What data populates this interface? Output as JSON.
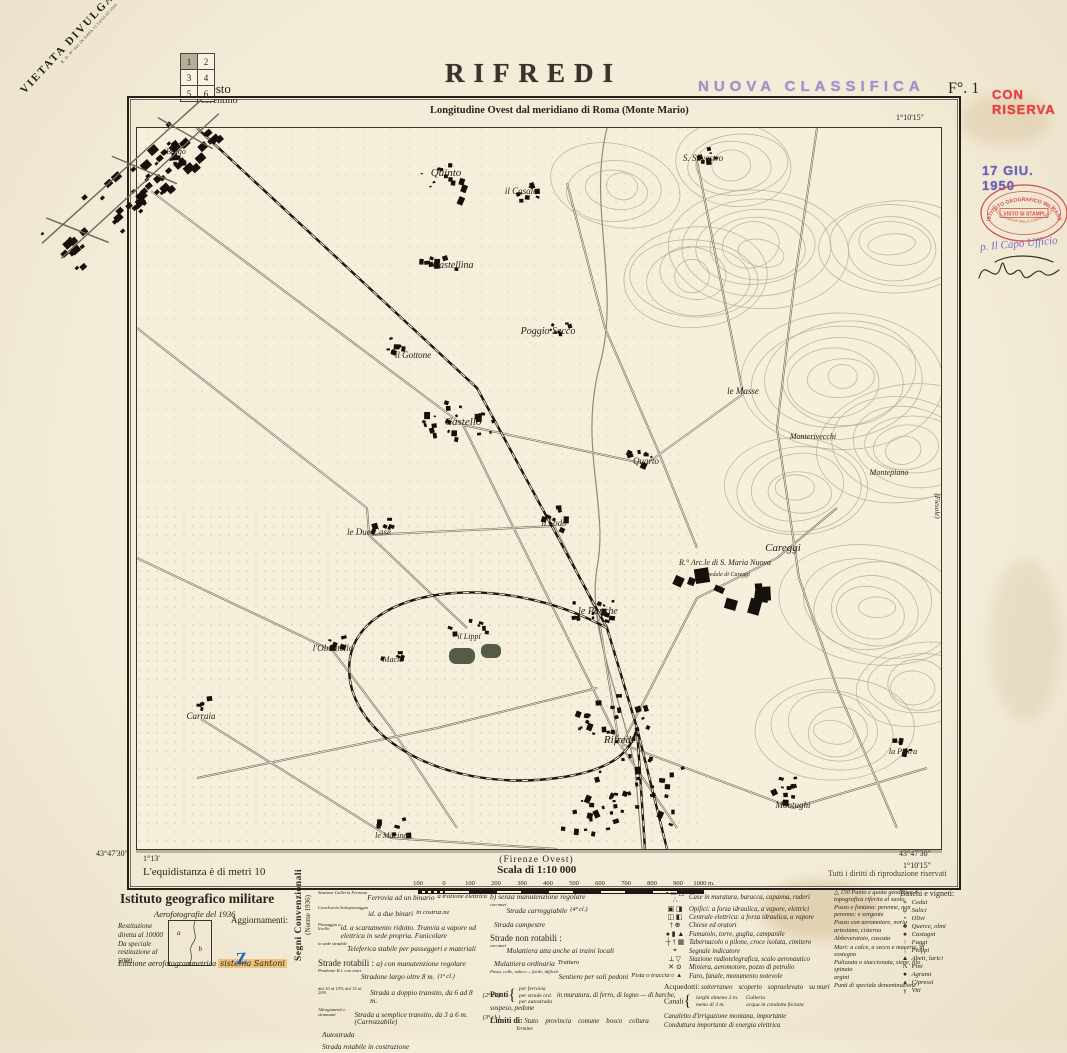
{
  "header": {
    "title": "RIFREDI",
    "classification_stamp": "NUOVA CLASSIFICA",
    "sheet_number": "F°. 1",
    "reserve_stamp": "CON RISERVA",
    "prohibition_line1": "VIETATA DIVULGAZIONE",
    "prohibition_line2": "R. D. N° 561 IN DATA 11 LUGLIO 1941",
    "subtitle": "Longitudine Ovest dal meridiano di Roma (Monte Mario)",
    "index_grid": [
      "1",
      "2",
      "3",
      "4",
      "5",
      "6"
    ],
    "outside_town_line1": "Sesto",
    "outside_town_line2": "Fiorentino"
  },
  "coordinates": {
    "top_right_lon": "1°10'15\"",
    "top_right_lat": "43°50'",
    "bottom_left_lat": "43°47'30\"",
    "bottom_left_lon": "1°13'",
    "bottom_right_lat": "43°47'30\"",
    "bottom_right_lon": "1°10'15\"",
    "right_edge_sheet": "(Fiesole)"
  },
  "map": {
    "labels": [
      {
        "t": "Borgo",
        "x": 39,
        "y": 26,
        "s": 8
      },
      {
        "t": "Quinto",
        "x": 309,
        "y": 48,
        "s": 11
      },
      {
        "t": "S. Silvestro",
        "x": 566,
        "y": 33,
        "s": 9
      },
      {
        "t": "il Casale",
        "x": 384,
        "y": 66,
        "s": 9
      },
      {
        "t": "Castellina",
        "x": 316,
        "y": 140,
        "s": 10
      },
      {
        "t": "Poggio Secco",
        "x": 411,
        "y": 206,
        "s": 10
      },
      {
        "t": "il Gottone",
        "x": 276,
        "y": 230,
        "s": 9
      },
      {
        "t": "Castello",
        "x": 326,
        "y": 297,
        "s": 11
      },
      {
        "t": "Quarto",
        "x": 509,
        "y": 336,
        "s": 9
      },
      {
        "t": "le Masse",
        "x": 606,
        "y": 266,
        "s": 9
      },
      {
        "t": "Monterivecchi",
        "x": 676,
        "y": 311,
        "s": 8
      },
      {
        "t": "Montepiano",
        "x": 752,
        "y": 347,
        "s": 8
      },
      {
        "t": "le Due Case",
        "x": 232,
        "y": 407,
        "s": 9
      },
      {
        "t": "il Sodo",
        "x": 417,
        "y": 398,
        "s": 9
      },
      {
        "t": "Careggi",
        "x": 646,
        "y": 423,
        "s": 11
      },
      {
        "t": "R.° Arc.le di S. Maria Nuova",
        "x": 588,
        "y": 437,
        "s": 8
      },
      {
        "t": "Ospedale di Careggi",
        "x": 588,
        "y": 448,
        "s": 6
      },
      {
        "t": "le Panche",
        "x": 461,
        "y": 486,
        "s": 10
      },
      {
        "t": "l'Olmatello",
        "x": 196,
        "y": 523,
        "s": 9
      },
      {
        "t": "Macia",
        "x": 256,
        "y": 534,
        "s": 8
      },
      {
        "t": "il Lippi",
        "x": 332,
        "y": 511,
        "s": 8
      },
      {
        "t": "Carraia",
        "x": 64,
        "y": 591,
        "s": 9
      },
      {
        "t": "Rifredi",
        "x": 482,
        "y": 615,
        "s": 11
      },
      {
        "t": "Montughi",
        "x": 656,
        "y": 680,
        "s": 9
      },
      {
        "t": "la Pietra",
        "x": 766,
        "y": 626,
        "s": 8
      },
      {
        "t": "le Macine",
        "x": 254,
        "y": 710,
        "s": 8
      },
      {
        "t": "(Fiesole)",
        "x": 798,
        "y": 378,
        "s": 7,
        "r": 90
      }
    ]
  },
  "footer": {
    "adjacent_sheet": "(Firenze Ovest)",
    "scale_title": "Scala di 1:10 000",
    "scale_ticks": [
      "100",
      "0",
      "100",
      "200",
      "300",
      "400",
      "500",
      "600",
      "700",
      "800",
      "900",
      "1000 m."
    ],
    "equidistance": "L'equidistanza è di metri 10",
    "rights": "Tutti i diritti di riproduzione riservati"
  },
  "stamps": {
    "date": "17 GIU. 1950",
    "oval_top": "ISTITUTO GEOGRAFICO MILITARE",
    "oval_middle": "VISTO SI STAMPI",
    "oval_bottom": "STAMPA E REVISIONE DELLE CARTE DELLO STATO",
    "handwritten_role": "p. Il Capo Ufficio"
  },
  "legend": {
    "institute": "Istituto geografico militare",
    "aerophoto": "Aerofotografie del 1936",
    "updates_label": "Aggiornamenti:",
    "diagram_a": "a",
    "diagram_b": "b",
    "sources": [
      "Restituzione diretta al 10000",
      "Da speciale restituzione al 5000"
    ],
    "edition_note": "Edizione aerofotogrammetrica",
    "edition_handwritten": "sistema Santoni",
    "edition_mark": "Z",
    "conventional_title": "Segni Convenzionali",
    "conventional_subtitle": "(Norme 1936)",
    "railways": [
      {
        "sym": "rail1",
        "micro": "Stazione   Galleria   Fermata",
        "label": "Ferrovia ad un binario",
        "cls": "a trazione elettrica"
      },
      {
        "sym": "rail2",
        "micro": "Cavalcavia   Sottopassaggio",
        "label": "id.  a due binari",
        "cls": "in costruz.ne"
      },
      {
        "sym": "railn",
        "micro": "Passaggio a livello",
        "label": "id.  a scartamento ridotto. Tranvia a vapore od elettrica in sede propria. Funicolare"
      },
      {
        "sym": "tele",
        "micro": "in sede stradale",
        "label": "Teleferica stabile per passeggeri e materiali"
      }
    ],
    "roads_title": "Strade rotabili :",
    "roads_a": "a) con manutenzione regolare",
    "roads": [
      {
        "sym": "road1",
        "micro": "Pendenze    K.l.    con muri",
        "label": "Stradone largo oltre 8 m.",
        "cls": "(1ª cl.)"
      },
      {
        "sym": "road2",
        "micro": "dal 10 al 15%   dal 15 al 20%",
        "label": "Strada a doppio transito, da 6 ad 8 m.",
        "cls": "(2ª cl.)"
      },
      {
        "sym": "road3",
        "micro": "Allargamenti e stramazzi",
        "label": "Strada a semplice transito, da 3 a 6 m. (Carrozzabile)",
        "cls": "(3ª cl.)"
      },
      {
        "sym": "auto",
        "label": "Autostrada"
      },
      {
        "sym": "roadc",
        "label": "Strada rotabile in costruzione"
      }
    ],
    "roads_b": "b) senza manutenzione regolare",
    "roads2": [
      {
        "sym": "carr",
        "micro": "con muri",
        "label": "Strada carreggiabile",
        "cls": "(4ª cl.)"
      },
      {
        "sym": "camp",
        "label": "Strada campestre"
      }
    ],
    "nonroads_title": "Strade non rotabili :",
    "nonroads": [
      {
        "sym": "mul1",
        "micro": "con muri",
        "label": "Mulattiera atta anche ai traini locali"
      },
      {
        "sym": "mul2",
        "label": "Mulattiera ordinaria",
        "cls": "Tratturo"
      },
      {
        "sym": "sent",
        "micro": "Passo, colle, valico — facile, difficile",
        "label": "Sentiero per soli pedoni",
        "cls": "Pista o traccia"
      }
    ],
    "bridges_title": "Ponti",
    "bridges_rows": [
      "per ferrovia",
      "per strade ord.",
      "per autostrada"
    ],
    "bridges_types1": "in muratura, di ferro, di legno",
    "bridges_types2": "di barche, sospeso, pedone",
    "limits_title": "Limiti di:",
    "limits_items": [
      "Stato",
      "provincia",
      "comune",
      "bosco",
      "coltura"
    ],
    "limits_sub": "Termine",
    "symbols": [
      {
        "g": "▪ ▭ △ ∴",
        "label": "Case in muratura, baracca, capanna, ruderi"
      },
      {
        "g": "▣ ◨",
        "label": "Opifici: a forza idraulica, a vapore, elettrici"
      },
      {
        "g": "◫ ◧",
        "label": "Centrale elettrica: a forza idraulica, a vapore"
      },
      {
        "g": "† ⊕",
        "label": "Chiese ed oratori"
      },
      {
        "g": "● ▮ ▲",
        "label": "Fumaiolo, torre, guglia, campanile"
      },
      {
        "g": "┼ † ▦",
        "label": "Tabernacolo o pilone, croce isolata, cimitero"
      },
      {
        "g": "⌖",
        "label": "Segnale indicatore"
      },
      {
        "g": "⟂ ▽",
        "label": "Stazione radiotelegrafica, scalo aeronautico"
      },
      {
        "g": "✕ ⊙",
        "label": "Miniera, aeromotore, pozzo di petrolio"
      },
      {
        "g": "☼ ▴",
        "label": "Faro, fanale, monumento notevole"
      }
    ],
    "aqueducts_title": "Acquedotti:",
    "aqueducts_items": [
      "sotterraneo",
      "scoperto",
      "sopraelevato",
      "su muri"
    ],
    "canals_title": "Canali",
    "canals_rows": [
      "larghi almeno 3 m.",
      "meno di 3 m."
    ],
    "canals_notes": [
      "Galleria",
      "acqua in condotta forzata"
    ],
    "canal_extra1": "Canaletto d'irrigazione montana, importante",
    "canal_extra2": "Conduttura importante di energia elettrica",
    "points": [
      "△ 150  Punto e quota geodetica e topografica riferita al suolo",
      "Pozzo e fontana: perenne, non perenne; e sorgente",
      "Pozzo con aeromotore, noria",
      "artesiano, cisterna",
      "Abbeveratoio, cascata",
      "Muri: a calce, a secco e macerie, di sostegno",
      "Palizzata o staccionata, siepe, filo spinato",
      "argini",
      "Punti di speciale denominazione"
    ],
    "woods_title": "Boschi e vigneti:",
    "woods": [
      {
        "g": "∗",
        "label": "Cedui"
      },
      {
        "g": "ψ",
        "label": "Salici"
      },
      {
        "g": "•",
        "label": "Olivi"
      },
      {
        "g": "♣",
        "label": "Querce, olmi"
      },
      {
        "g": "♠",
        "label": "Castagni"
      },
      {
        "g": "↑",
        "label": "Faggi"
      },
      {
        "g": "|",
        "label": "Pioppi"
      },
      {
        "g": "▲",
        "label": "Abeti, larici"
      },
      {
        "g": "Λ",
        "label": "Pini"
      },
      {
        "g": "●",
        "label": "Agrumi"
      },
      {
        "g": "▴",
        "label": "Cipressi"
      },
      {
        "g": "γ",
        "label": "Viti"
      }
    ]
  }
}
